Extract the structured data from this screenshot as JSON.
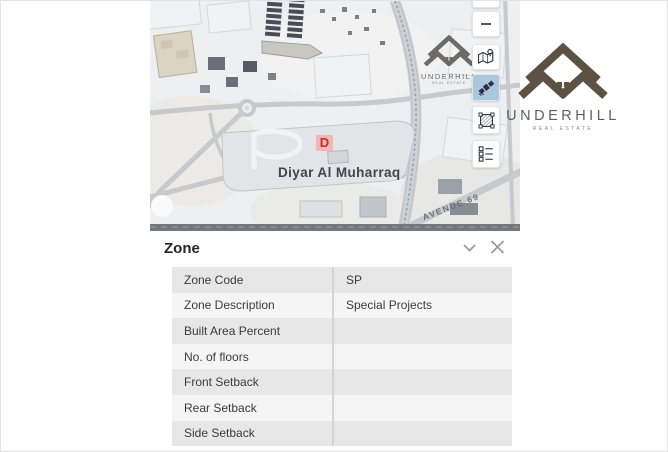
{
  "map": {
    "place_label": "Diyar Al Muharraq",
    "street_label": "AVENUE  69",
    "marker_label": "D",
    "toolbar": [
      {
        "name": "zoom-out-button",
        "icon": "minus-icon",
        "active": false
      },
      {
        "name": "basemap-button",
        "icon": "map-pin-icon",
        "active": false
      },
      {
        "name": "satellite-button",
        "icon": "satellite-icon",
        "active": true
      },
      {
        "name": "parcel-net-button",
        "icon": "net-grid-icon",
        "active": false
      },
      {
        "name": "legend-button",
        "icon": "legend-list-icon",
        "active": false
      }
    ]
  },
  "watermark": {
    "name": "UNDERHILL",
    "tagline": "REAL ESTATE"
  },
  "logo": {
    "name": "UNDERHILL",
    "tagline": "REAL ESTATE"
  },
  "zone_panel": {
    "title": "Zone",
    "rows": [
      {
        "label": "Zone Code",
        "value": "SP"
      },
      {
        "label": "Zone Description",
        "value": "Special Projects"
      },
      {
        "label": "Built Area Percent",
        "value": ""
      },
      {
        "label": "No. of floors",
        "value": ""
      },
      {
        "label": "Front Setback",
        "value": ""
      },
      {
        "label": "Rear Setback",
        "value": ""
      },
      {
        "label": "Side Setback",
        "value": ""
      }
    ]
  },
  "colors": {
    "accent_blue": "#a9c8dd",
    "logo_brown": "#5b5244",
    "marker_red": "#cf2b25",
    "marker_bg": "#f3afb2",
    "row_gray": "#e7e7e8",
    "row_light": "#f5f5f6",
    "map_road": "#c7c9cd",
    "map_bg": "#edeff1"
  }
}
